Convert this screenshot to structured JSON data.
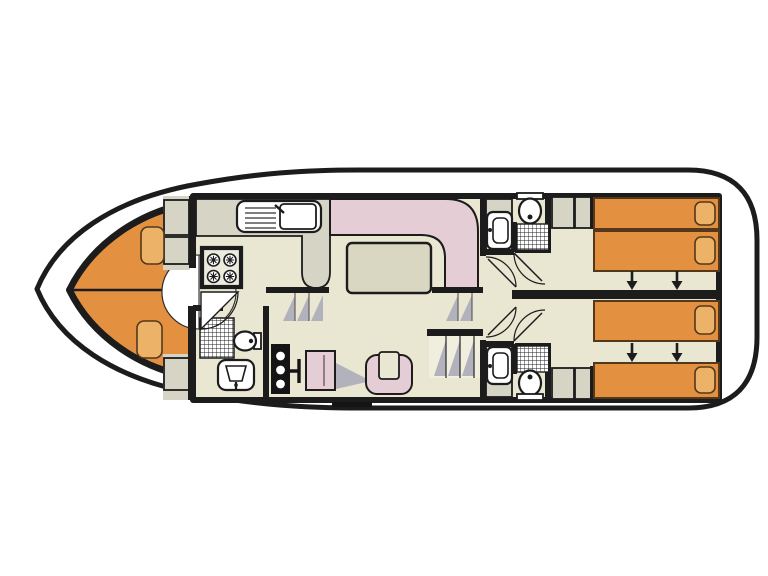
{
  "meta": {
    "title": "houseboat-floor-plan",
    "type": "top-view-deck-plan",
    "orientation": "bow-left"
  },
  "colors": {
    "background": "#ffffff",
    "wall": "#1c1c1c",
    "floor": "#e9e6d2",
    "cabinet": "#d5d4c5",
    "bed_orange": "#e39140",
    "pillow_orange": "#ecb267",
    "upholstery_pink": "#e4cdd4",
    "table_top": "#d9d7c2",
    "step_shadow": "#b2b2bc",
    "fixture_white": "#ffffff",
    "stove_top": "#ecebdd",
    "bed_outline": "#53381b"
  },
  "plan": {
    "rooms": [
      {
        "id": "bow-cabin",
        "features": [
          "v-berth-bed",
          "v-berth-bed",
          "pillow",
          "pillow",
          "wardrobe",
          "door-swing"
        ]
      },
      {
        "id": "galley",
        "features": [
          "kitchen-sink",
          "drainer",
          "stove-four-burners",
          "counter-peninsula"
        ]
      },
      {
        "id": "saloon",
        "features": [
          "l-shaped-sofa",
          "dining-table",
          "steps-to-bow",
          "steps-to-aft"
        ]
      },
      {
        "id": "helm-station",
        "features": [
          "instrument-console",
          "throttle-lever",
          "helm-chair",
          "u-shaped-chair",
          "boarding-step"
        ]
      },
      {
        "id": "day-head",
        "features": [
          "shower",
          "toilet",
          "washbasin",
          "door-swing"
        ]
      },
      {
        "id": "companionway",
        "features": [
          "stairs",
          "corridor",
          "door-swing",
          "door-swing"
        ]
      },
      {
        "id": "aft-cabin-top",
        "features": [
          "single-bed",
          "single-bed",
          "pillow",
          "pillow",
          "slide-together-arrows",
          "wardrobe",
          "ensuite-shower",
          "ensuite-toilet",
          "ensuite-washbasin"
        ]
      },
      {
        "id": "aft-cabin-bottom",
        "features": [
          "single-bed",
          "single-bed",
          "pillow",
          "pillow",
          "slide-together-arrows",
          "wardrobe",
          "ensuite-shower",
          "ensuite-toilet",
          "ensuite-washbasin"
        ]
      }
    ],
    "berth_count": 6,
    "arrow_direction": "down"
  }
}
